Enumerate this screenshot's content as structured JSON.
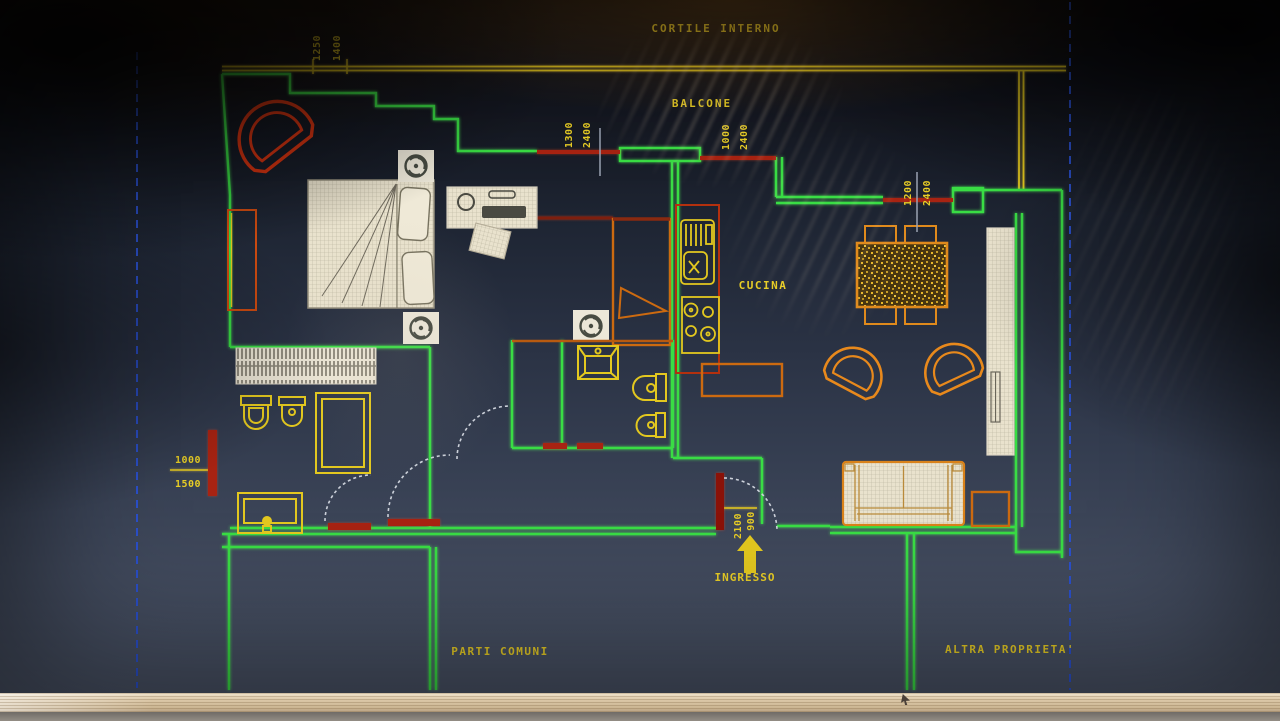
{
  "labels": {
    "cortile_interno": "CORTILE INTERNO",
    "balcone": "BALCONE",
    "cucina": "CUCINA",
    "ingresso": "INGRESSO",
    "parti_comuni": "PARTI COMUNI",
    "altra_proprieta": "ALTRA PROPRIETA'"
  },
  "dims": {
    "balcony_door": {
      "w": "1250",
      "h": "1400"
    },
    "studio_window": {
      "w": "1300",
      "h": "2400"
    },
    "kitchen_window": {
      "w": "1000",
      "h": "2400"
    },
    "living_window": {
      "w": "1200",
      "h": "2400"
    },
    "left_window": {
      "w": "1000",
      "h": "1500"
    },
    "entrance_door": {
      "w": "900",
      "h": "2100"
    }
  },
  "icons": {
    "ceiling_light": "fan-circle",
    "entrance_arrow": "arrow-up"
  },
  "colors": {
    "wall_green": "#39dd44",
    "cad_yellow": "#e8cd25",
    "window_red": "#a82312",
    "furniture_orange": "#e08a1c",
    "armchair_red": "#da3512",
    "boundary_blue": "#2b50cc",
    "fill_beige": "#e7e0cb"
  }
}
